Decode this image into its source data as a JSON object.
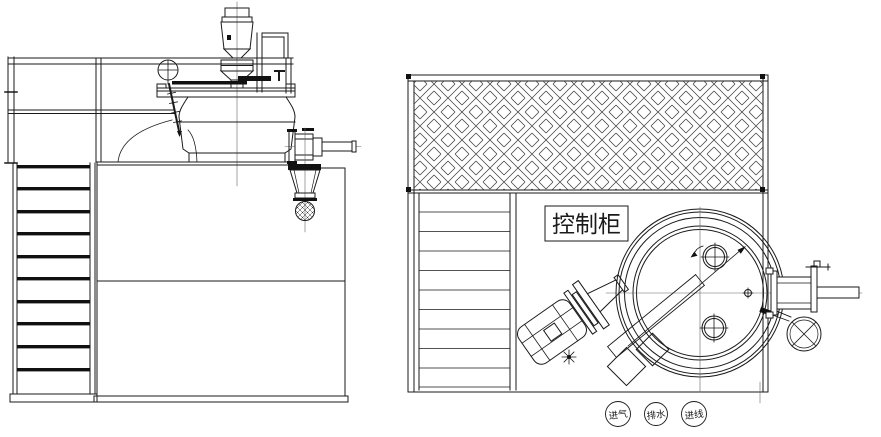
{
  "colors": {
    "line": "#1a1a1a",
    "thin_line": "#666666",
    "background": "#ffffff"
  },
  "plan_view": {
    "control_cabinet_label": "控制柜",
    "utility_tags": [
      {
        "text": "进气"
      },
      {
        "text": "排水"
      },
      {
        "text": "进线"
      }
    ]
  }
}
